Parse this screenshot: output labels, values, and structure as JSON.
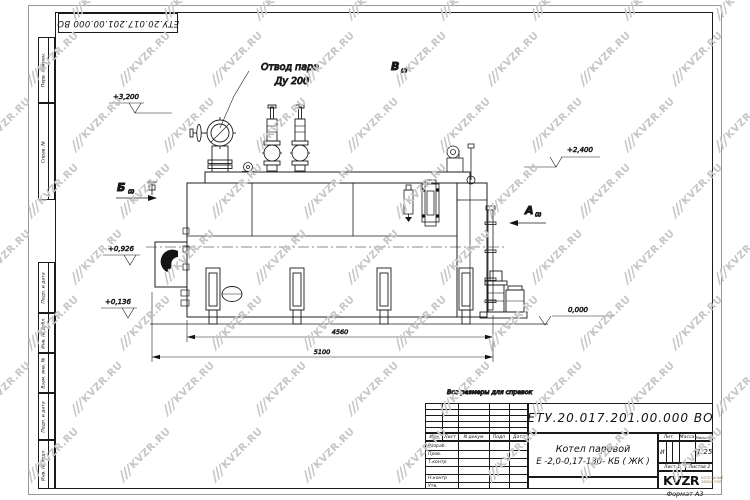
{
  "sheet": {
    "stamp_top": "ЕТУ.20.017.201.00.000  ВО",
    "format_label": "Формат  А3"
  },
  "margin_labels": [
    "Перв. примен.",
    "Справ. №",
    "Подп. и дата",
    "Инв. № дубл.",
    "Взам. инв. №",
    "Подп. и дата",
    "Инв. № подл."
  ],
  "watermark": {
    "text": "KVZR.RU",
    "color": "#c6c6c6"
  },
  "drawing": {
    "callout_line1": "Отвод пара",
    "callout_line2": "Ду 200",
    "elev_3200": "+3,200",
    "elev_2400": "+2,400",
    "elev_0926": "+0,926",
    "elev_0136": "+0,136",
    "elev_0000": "0,000",
    "view_b": "Б",
    "view_v": "В",
    "view_a": "А",
    "view_sheet_ref": "(2)",
    "dim_inner": "4560",
    "dim_outer": "5100",
    "note": "Все размеры для справок"
  },
  "title_block": {
    "doc_number": "ЕТУ.20.017.201.00.000  ВО",
    "product_line1": "Котел паровой",
    "product_line2": "Е -2,0-0,17-130- КБ ( ЖК )",
    "header_cols": [
      "Изм",
      "Лист",
      "N докум",
      "Подп",
      "Дата"
    ],
    "staff_rows": [
      "Разраб.",
      "Пров.",
      "Т.контр",
      "Н.контр",
      "Утв."
    ],
    "lit_header": "Лит.",
    "mass_header": "Масса",
    "scale_header": "Масштаб",
    "lit_value": "И",
    "scale_value": "1:25",
    "sheet_info": "Лист 1",
    "sheets_info": "Листов 2",
    "logo_text": "KVZR",
    "logo_sub1": "КОТЕЛЬНЫЙ",
    "logo_sub2": "ЗАВОД РЭП"
  }
}
